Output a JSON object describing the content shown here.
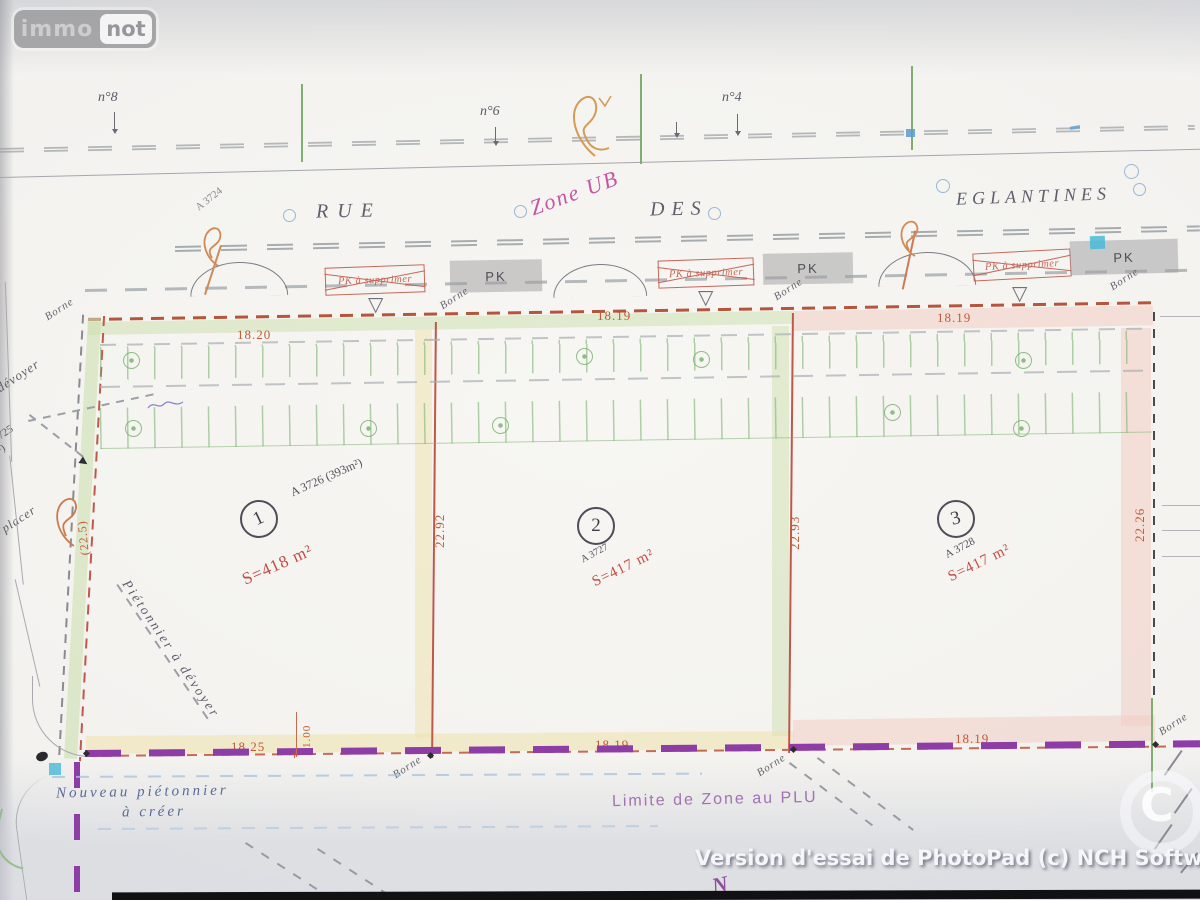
{
  "logo": {
    "immo": "immo",
    "not": "not"
  },
  "road": {
    "house_numbers": [
      "n°8",
      "n°6",
      "n°4"
    ],
    "rue": "RUE",
    "des": "DES",
    "eglantines": "EGLANTINES",
    "zone": "Zone UB",
    "ref_top": "A 3724"
  },
  "parking": {
    "pk": "PK",
    "pk_remove": "PK à supprimer"
  },
  "lots": [
    {
      "num": "1",
      "ref": "A 3726 (393m²)",
      "area": "S=418 m²",
      "top": "18.20",
      "bottom": "18.25",
      "side": "22.92"
    },
    {
      "num": "2",
      "ref": "A 3727",
      "area": "S=417 m²",
      "top": "18.19",
      "bottom": "18.19",
      "side": "22.93"
    },
    {
      "num": "3",
      "ref": "A 3728",
      "area": "S=417 m²",
      "top": "18.19",
      "bottom": "18.19",
      "side": "22.26"
    }
  ],
  "annotations": {
    "borne": "Borne",
    "left_dim": "(22.5)",
    "offset_dim": "1.00",
    "pieton_devoyer": "Piétonnier à dévoyer",
    "left_devoyer": "dévoyer",
    "left_ref": "3725",
    "left_area": "(25 m²)",
    "left_placer": "placer",
    "nouveau_1": "Nouveau piétonnier",
    "nouveau_2": "à créer",
    "limite": "Limite de Zone au PLU"
  },
  "watermark": {
    "trial": "Version d'essai de PhotoPad (c) NCH Software",
    "letter": "C",
    "north": "N"
  }
}
